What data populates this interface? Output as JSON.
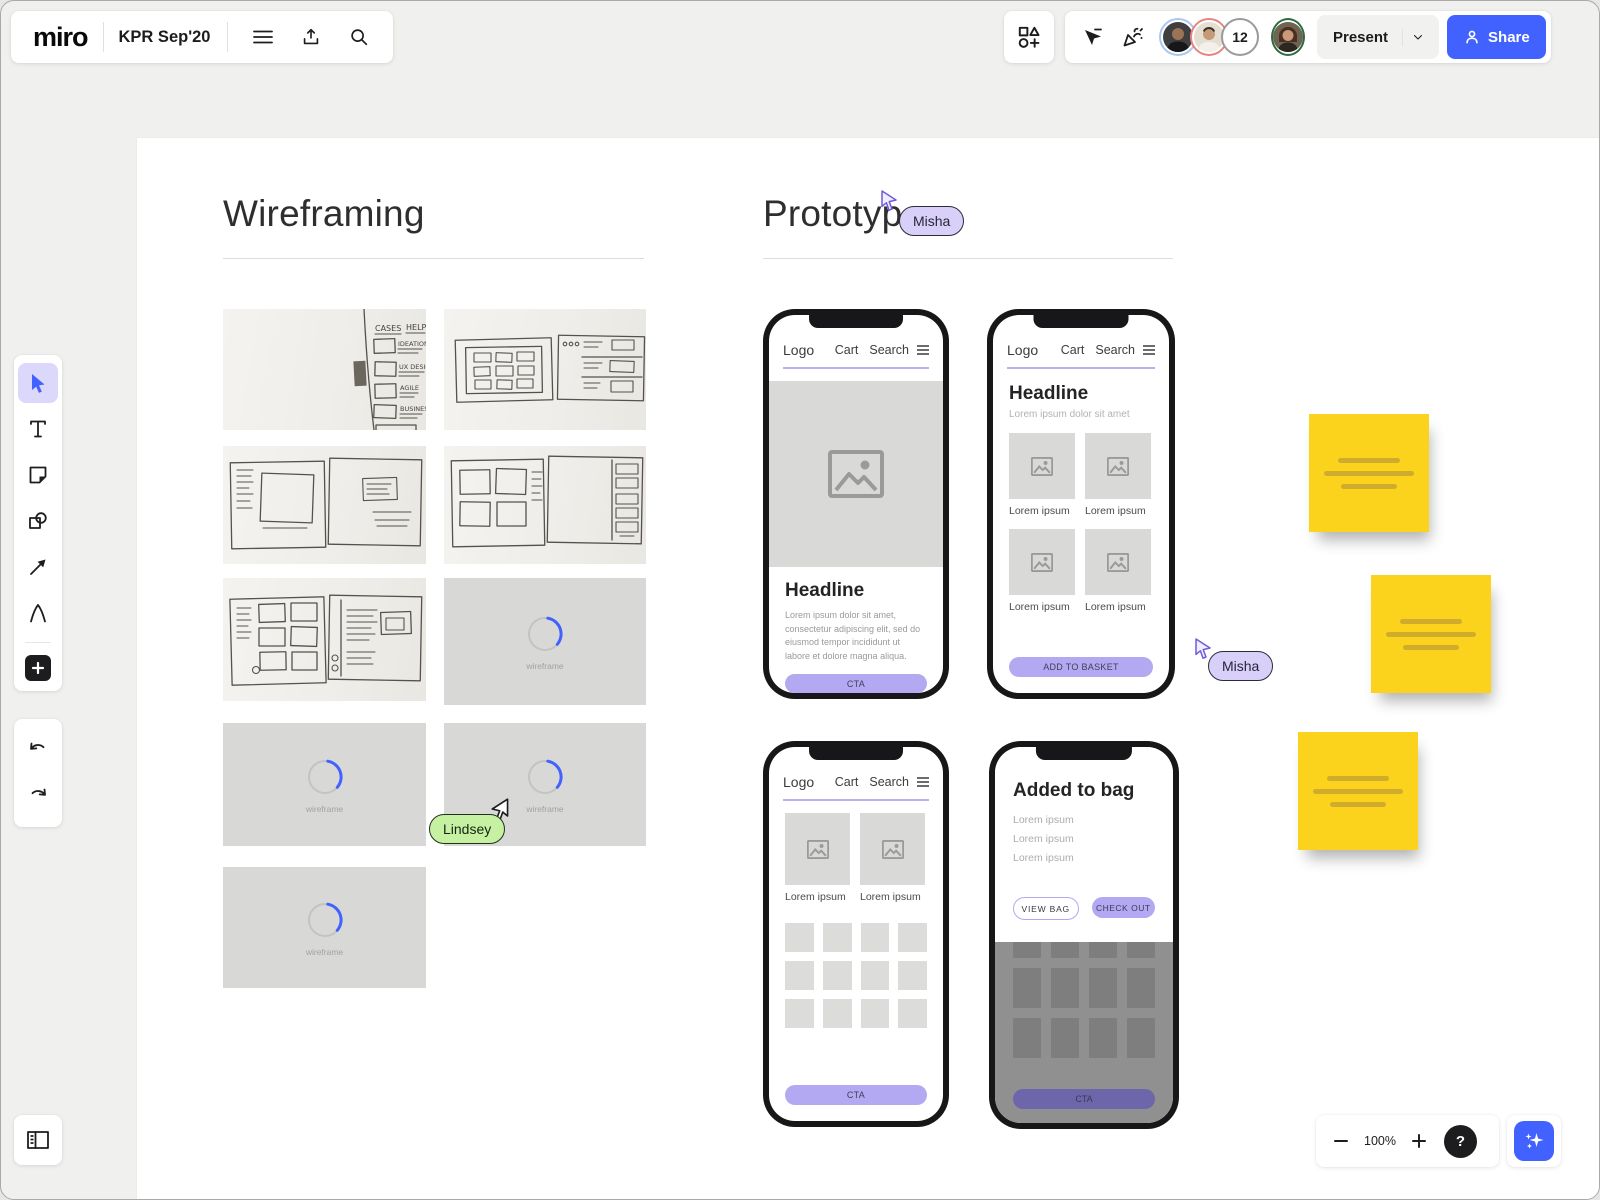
{
  "topbar": {
    "logo": "miro",
    "board_title": "KPR Sep'20"
  },
  "presence": {
    "overflow_count": "12",
    "present_label": "Present",
    "share_label": "Share"
  },
  "controls": {
    "zoom_level": "100%",
    "help_label": "?"
  },
  "cursors": {
    "misha": "Misha",
    "lindsey": "Lindsey"
  },
  "board": {
    "wireframing_title": "Wireframing",
    "prototyping_title": "Prototyp",
    "loading_label": "wireframe",
    "sketch": {
      "header_left": "CASES",
      "header_right": "HELP",
      "items": [
        "IDEATION",
        "UX DESIGN",
        "AGILE",
        "BUSINESS"
      ]
    },
    "phone_nav": {
      "logo": "Logo",
      "cart": "Cart",
      "search": "Search"
    },
    "phone1": {
      "headline": "Headline",
      "body": "Lorem ipsum dolor sit amet, consectetur adipiscing elit, sed do eiusmod tempor incididunt ut labore et dolore magna aliqua.",
      "cta": "CTA"
    },
    "phone2": {
      "headline": "Headline",
      "subtitle": "Lorem ipsum dolor sit amet",
      "captions": [
        "Lorem ipsum",
        "Lorem ipsum",
        "Lorem ipsum",
        "Lorem ipsum"
      ],
      "cta": "ADD TO BASKET"
    },
    "phone3": {
      "captions": [
        "Lorem ipsum",
        "Lorem ipsum"
      ],
      "cta": "CTA"
    },
    "phone4": {
      "title": "Added to bag",
      "lines": [
        "Lorem ipsum",
        "Lorem ipsum",
        "Lorem ipsum"
      ],
      "view_bag": "VIEW BAG",
      "check_out": "CHECK OUT",
      "cta": "CTA"
    }
  },
  "colors": {
    "accent_blue": "#4262ff",
    "cta_purple": "#b3a9f2",
    "sticky_yellow": "#fcd31c",
    "misha_purple": "#d8d0f8",
    "lindsey_green": "#c6f1a2"
  }
}
